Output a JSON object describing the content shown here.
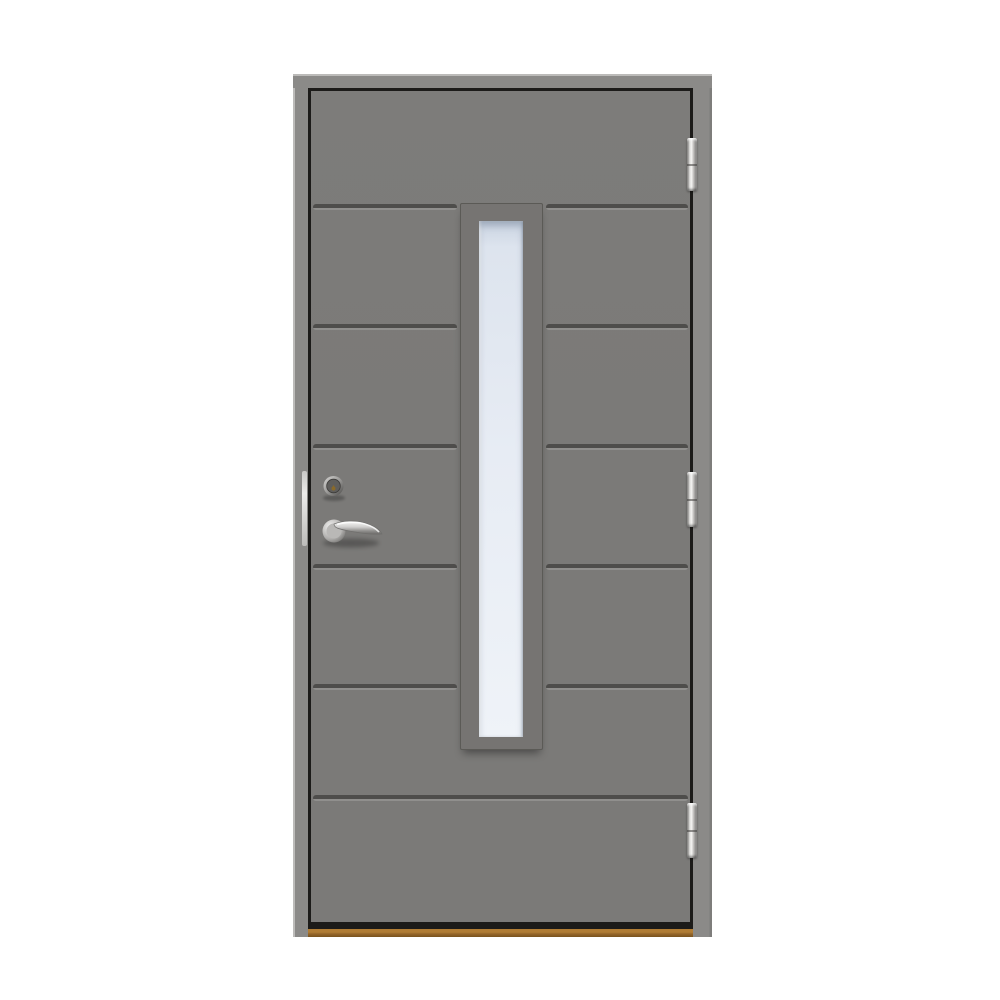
{
  "scene": {
    "description": "Product photo of a grey exterior front door with seven horizontal panels, a tall narrow vertical glazing, chrome lever handle, cylinder lock, three chrome hinges and a wooden threshold, on a plain white background",
    "text_content": "none"
  },
  "door": {
    "panel_count": 7,
    "groove_count": 6,
    "hinge_count": 3,
    "window": {
      "type": "vertical-glass-pane",
      "position": "center"
    },
    "hardware": {
      "handle": "chrome lever handle on round rose",
      "lock": "chrome cylinder lock with brass keyhole",
      "strike_plate": "chrome strike plate on frame",
      "hinges": [
        "top",
        "middle",
        "bottom"
      ],
      "finish": "chrome"
    },
    "threshold_material": "wood"
  },
  "colors": {
    "background": "#ffffff",
    "frame": "#8b8a88",
    "frame-highlight": "#bcbbb9",
    "frame-shade": "#7e7d7b",
    "reveal": "#1c1b19",
    "leaf": "#7b7a78",
    "groove-dark": "#4e4d4b",
    "groove-light": "#908f8d",
    "window-frame": "#767472",
    "window-frame-dark": "#5b5a56",
    "glass-top": "#c9d3e1",
    "glass": "#e7ecf4",
    "chrome-light": "#f5f5f3",
    "chrome-mid": "#bdbcba",
    "chrome-dark": "#5f5e5c",
    "keyhole": "#8a6a2a",
    "wood-light": "#b07c34",
    "wood-dark": "#7a521d"
  }
}
